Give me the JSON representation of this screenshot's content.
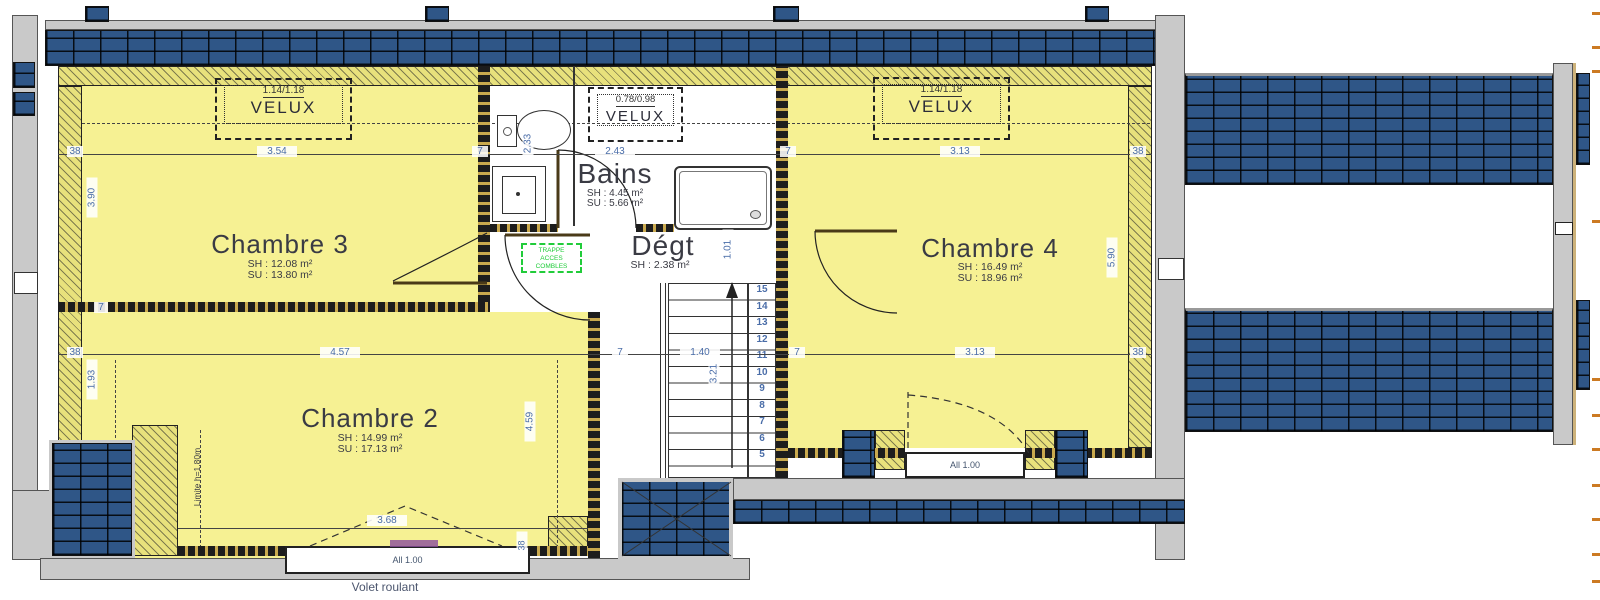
{
  "plan": {
    "rooms": {
      "chambre3": {
        "name": "Chambre 3",
        "sh": "SH : 12.08 m²",
        "su": "SU : 13.80 m²"
      },
      "chambre2": {
        "name": "Chambre 2",
        "sh": "SH : 14.99 m²",
        "su": "SU : 17.13 m²"
      },
      "chambre4": {
        "name": "Chambre 4",
        "sh": "SH : 16.49 m²",
        "su": "SU : 18.96 m²"
      },
      "bains": {
        "name": "Bains",
        "sh": "SH : 4.45 m²",
        "su": "SU : 5.66 m²"
      },
      "degt": {
        "name": "Dégt",
        "sh": "SH : 2.38 m²"
      }
    },
    "velux": {
      "left": {
        "size": "1.14/1.18",
        "label": "VELUX"
      },
      "middle": {
        "size": "0.78/0.98",
        "label": "VELUX"
      },
      "right": {
        "size": "1.14/1.18",
        "label": "VELUX"
      }
    },
    "windows": {
      "left_allege": "All 1.00",
      "right_allege": "All 1.00",
      "volet": "Volet roulant"
    },
    "annotations": {
      "limite": "Limite h=1.80m",
      "trappe": [
        "TRAPPE",
        "ACCES",
        "COMBLES"
      ]
    },
    "stairs": {
      "numbers": [
        "15",
        "14",
        "13",
        "12",
        "11",
        "10",
        "9",
        "8",
        "7",
        "6",
        "5"
      ],
      "length": "3.21"
    },
    "dims": {
      "top": [
        "38",
        "3.54",
        "7",
        "2.43",
        "7",
        "3.13",
        "38"
      ],
      "mid": [
        "38",
        "4.57",
        "7",
        "1.40",
        "7",
        "3.13",
        "38"
      ],
      "wc_depth": "2.33",
      "left_upper": "3.90",
      "left_seven": "7",
      "left_lower": "1.93",
      "right_height": "5.90",
      "ch2_height": "4.59",
      "degt_width": "1.01",
      "ch2_window_width": "3.68",
      "window_jamb": "38"
    },
    "colors": {
      "room_fill": "#f6f193",
      "insulation": "#e8e17c",
      "brick_blue": "#2f5687",
      "wall_gray": "#c9c9c9",
      "dim_text": "#4a6da8",
      "label_text": "#3a3b44",
      "trappe_green": "#21cc3a",
      "annotation_purple": "#8c4d9e",
      "edge_tick_orange": "#cc7a22"
    }
  }
}
